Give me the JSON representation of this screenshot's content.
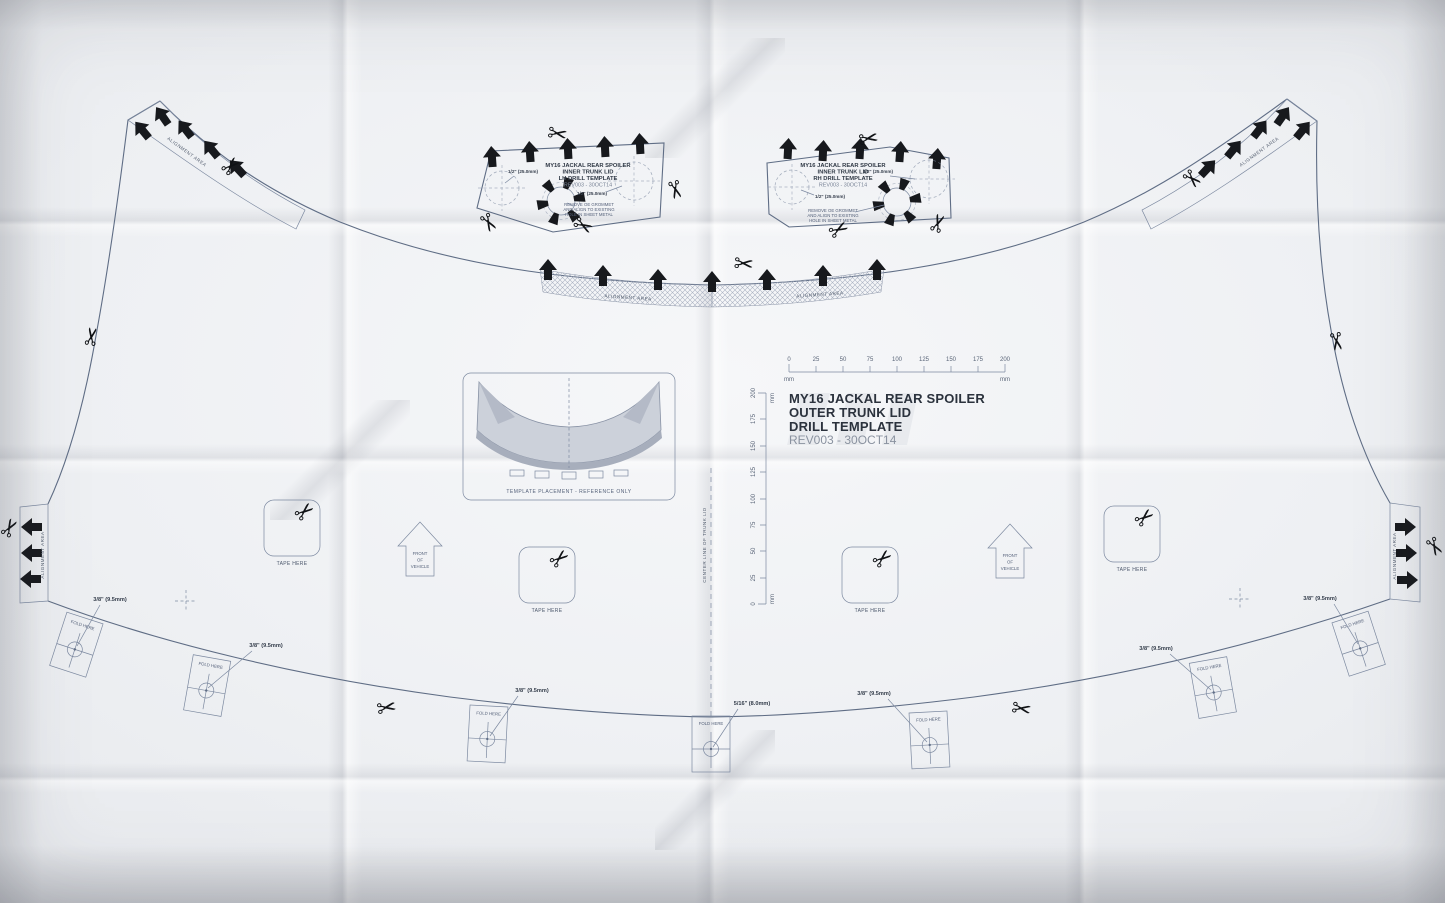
{
  "colors": {
    "ink": "#5f6d85",
    "ink_dark": "#2b323d",
    "black": "#17191d",
    "paper": "#f0f1f4"
  },
  "icons": {
    "scissors": "✂"
  },
  "title_block": {
    "line1": "MY16 JACKAL REAR SPOILER",
    "line2": "OUTER TRUNK LID",
    "line3": "DRILL TEMPLATE",
    "line4": "REV003 - 30OCT14"
  },
  "lh_template": {
    "line1": "MY16 JACKAL REAR SPOILER",
    "line2": "INNER TRUNK LID",
    "line3": "LH DRILL TEMPLATE",
    "line4": "REV003 - 30OCT14",
    "note1": "REMOVE OE GROMMET",
    "note2": "AND ALIGN TO EXISTING",
    "note3": "HOLE IN SHEET METAL",
    "hole": "1/2\" (25.0mm)"
  },
  "rh_template": {
    "line1": "MY16 JACKAL REAR SPOILER",
    "line2": "INNER TRUNK LID",
    "line3": "RH DRILL TEMPLATE",
    "line4": "REV003 - 30OCT14",
    "note1": "REMOVE OE GROMMET",
    "note2": "AND ALIGN TO EXISTING",
    "note3": "HOLE IN SHEET METAL",
    "hole": "1/2\" (25.0mm)"
  },
  "labels": {
    "alignment_area": "ALIGNMENT AREA",
    "tape_here": "TAPE HERE",
    "fold_here": "FOLD HERE",
    "front": "FRONT",
    "of": "OF",
    "vehicle": "VEHICLE",
    "center_line": "CENTER LINE OF TRUNK LID",
    "placement": "TEMPLATE PLACEMENT - REFERENCE ONLY",
    "drill_38": "3/8\" (9.5mm)",
    "drill_516": "5/16\" (8.0mm)"
  },
  "ruler": {
    "ticks": [
      "0",
      "25",
      "50",
      "75",
      "100",
      "125",
      "150",
      "175",
      "200"
    ],
    "unit": "mm"
  }
}
